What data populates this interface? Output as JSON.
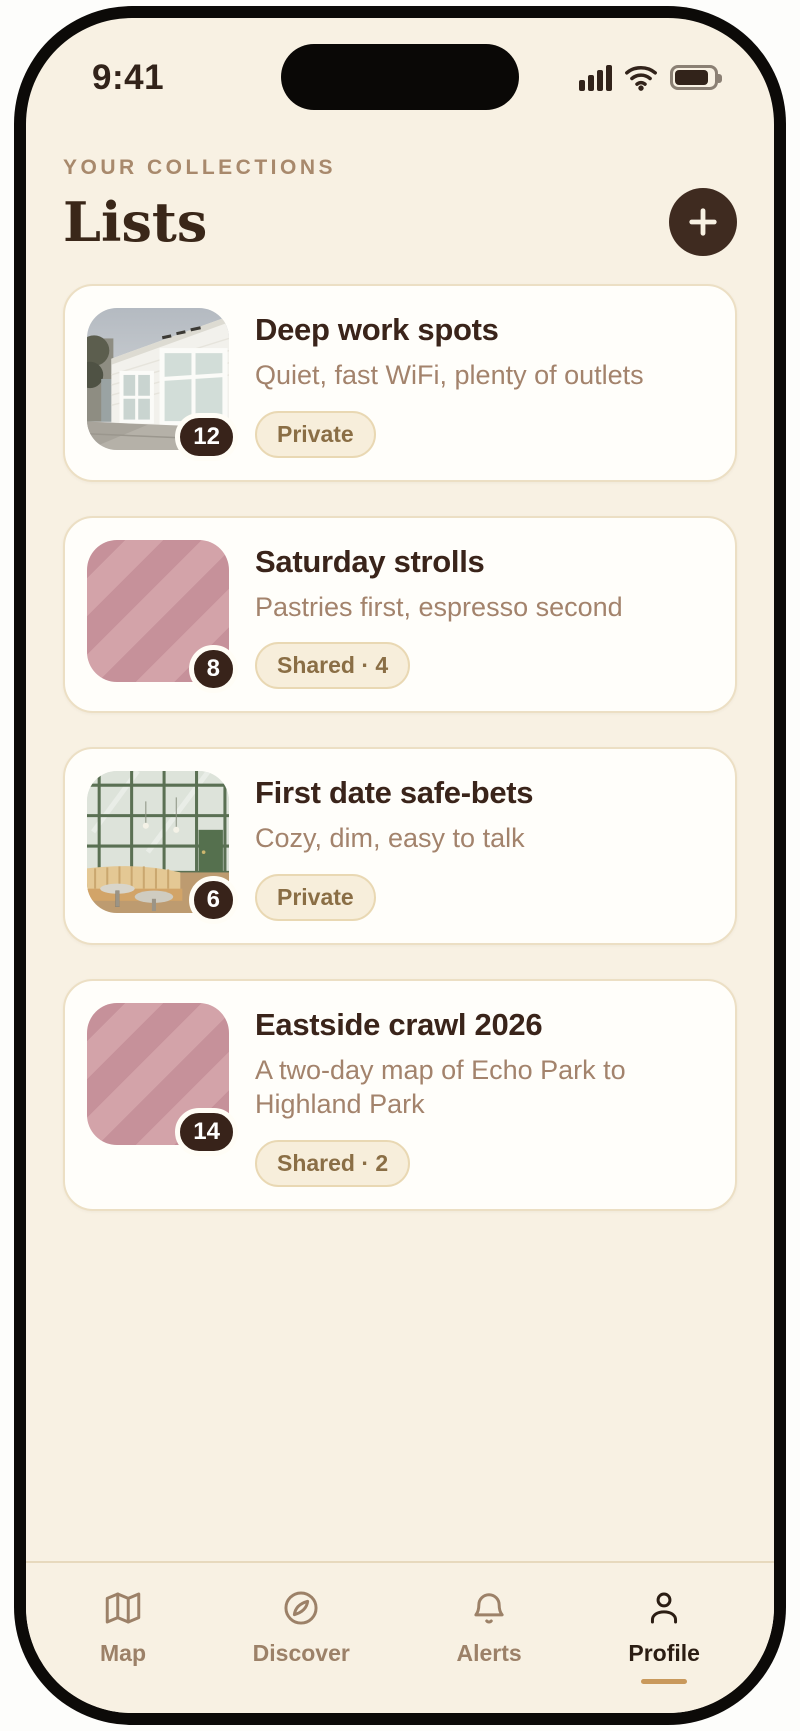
{
  "status_bar": {
    "time": "9:41",
    "icons": [
      "signal-icon",
      "wifi-icon",
      "battery-icon"
    ]
  },
  "header": {
    "eyebrow": "YOUR COLLECTIONS",
    "title": "Lists",
    "add_button_icon": "plus-icon"
  },
  "lists": [
    {
      "title": "Deep work spots",
      "subtitle": "Quiet, fast WiFi, plenty of outlets",
      "badge": "Private",
      "count": "12",
      "thumb": "photo-storefront"
    },
    {
      "title": "Saturday strolls",
      "subtitle": "Pastries first, espresso second",
      "badge": "Shared · 4",
      "count": "8",
      "thumb": "striped-placeholder"
    },
    {
      "title": "First date safe-bets",
      "subtitle": "Cozy, dim, easy to talk",
      "badge": "Private",
      "count": "6",
      "thumb": "photo-cafe"
    },
    {
      "title": "Eastside crawl 2026",
      "subtitle": "A two-day map of Echo Park to Highland Park",
      "badge": "Shared · 2",
      "count": "14",
      "thumb": "striped-placeholder"
    }
  ],
  "tab_bar": {
    "tabs": [
      {
        "label": "Map",
        "icon": "map-icon",
        "active": false
      },
      {
        "label": "Discover",
        "icon": "compass-icon",
        "active": false
      },
      {
        "label": "Alerts",
        "icon": "bell-icon",
        "active": false
      },
      {
        "label": "Profile",
        "icon": "person-icon",
        "active": true
      }
    ]
  },
  "colors": {
    "screen_bg": "#f8f1e3",
    "card_bg": "#fffefa",
    "card_border": "#ecdfc4",
    "ink": "#3a241a",
    "muted_text": "#a3836c",
    "eyebrow_text": "#a8896c",
    "badge_bg": "#f7eedb",
    "badge_border": "#e9d8b3",
    "badge_text": "#8a6e45",
    "accent_dark": "#3f2b20",
    "count_badge_bg": "#38231a",
    "stripe_dark": "#c6919a",
    "stripe_light": "#d3a3a9",
    "tab_inactive": "#9c8168",
    "tab_active": "#2b1d13",
    "active_underline": "#c9995c"
  }
}
